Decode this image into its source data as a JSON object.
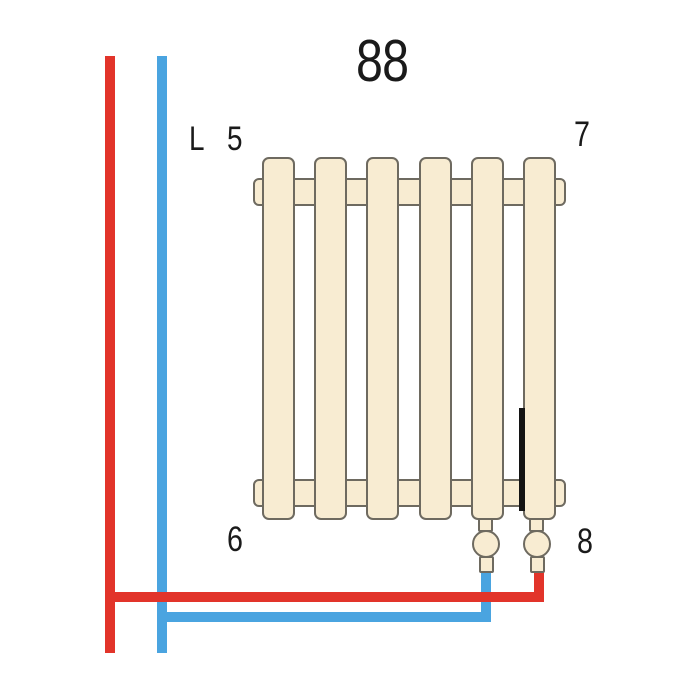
{
  "diagram": {
    "type": "radiator-piping-connection-diagram",
    "labels": {
      "size_top": "88",
      "left_letter": "L",
      "top_left_number": "5",
      "top_right_number": "7",
      "bottom_left_number": "6",
      "bottom_right_number": "8"
    },
    "radiator": {
      "columns": 6
    },
    "colors": {
      "supply_red": "#e2342a",
      "return_blue": "#4aa4e0",
      "radiator_fill": "#f8ecd2",
      "radiator_outline": "#6e6a60",
      "marker": "#141414",
      "text": "#1a1a1a",
      "background": "#ffffff"
    }
  }
}
